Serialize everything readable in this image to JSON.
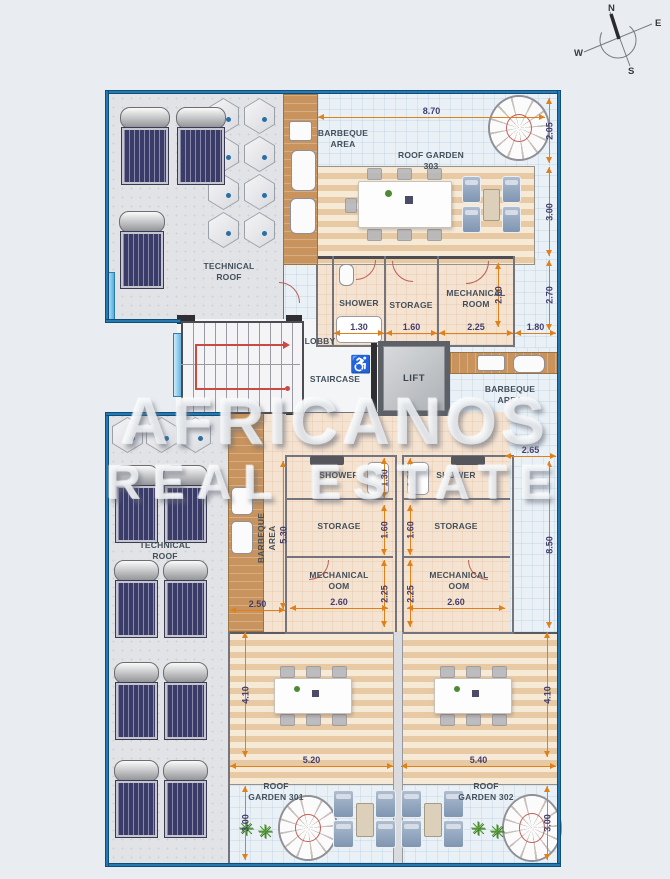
{
  "compass": {
    "north": "N",
    "east": "E",
    "south": "S",
    "west": "W"
  },
  "areas": {
    "barbeque_area": "BARBEQUE AREA",
    "roof_garden_303": "ROOF GARDEN 303",
    "roof_garden_301": "ROOF GARDEN 301",
    "roof_garden_302": "ROOF GARDEN 302",
    "technical_roof": "TECHNICAL ROOF"
  },
  "rooms": {
    "shower": "SHOWER",
    "storage": "STORAGE",
    "mechanical_room": "MECHANICAL ROOM",
    "mechanical_oom": "MECHANICAL OOM",
    "lobby": "LOBBY",
    "staircase": "STAIRCASE",
    "lift": "LIFT"
  },
  "dims": {
    "top_width": "8.70",
    "right_top": "2.05",
    "right_upper": "3.00",
    "right_mid": "2.70",
    "row_shower": "1.30",
    "row_storage": "1.60",
    "row_mech": "2.25",
    "row_end": "1.80",
    "mech_height": "2.60",
    "gap_right": "2.65",
    "right_lower": "8.50",
    "left_lower": "5.30",
    "left_width": "2.50",
    "unit_shower": "1.30",
    "unit_storage": "1.60",
    "unit_mech": "2.25",
    "unit_width": "2.60",
    "deck_height": "4.10",
    "garden301_width": "5.20",
    "garden302_width": "5.40",
    "bottom_height": "3.00"
  },
  "watermark": {
    "line1": "AFRICANOS",
    "line2": "REAL ESTATE"
  },
  "accessibility": {
    "wheelchair": "♿"
  },
  "plant_glyph": "✳",
  "colors": {
    "wall_blue": "#2679b1",
    "dim_orange": "#e08018",
    "solar_navy": "#3b3b68",
    "deck_tan": "#e7c9a3"
  }
}
